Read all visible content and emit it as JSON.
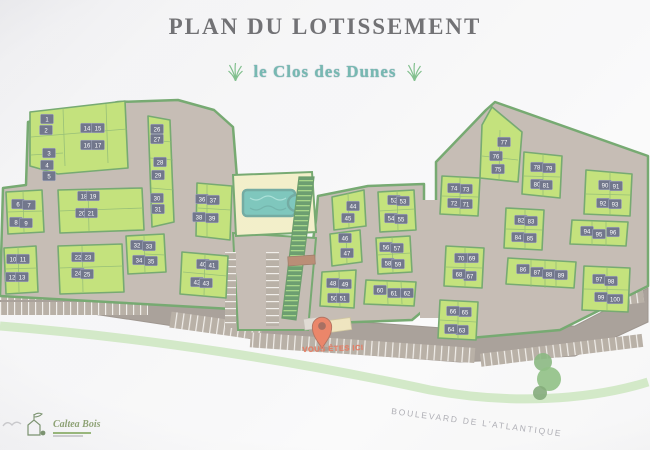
{
  "title": "PLAN DU LOTISSEMENT",
  "subtitle": "le Clos des Dunes",
  "you_are_here_label": "VOUS ÊTES ICI",
  "street_label": "BOULEVARD DE L'ATLANTIQUE",
  "logo": {
    "name": "Caltea Bois"
  },
  "colors": {
    "parcel_green": "#a5d337",
    "hedge_green": "#2e7d27",
    "road_taupe": "#a79a8e",
    "boulevard": "#7d7065",
    "lot_chip": "#262e4e",
    "pool_teal": "#3aa99a",
    "pool_parcel_tan": "#ece7ad",
    "pin_red": "#e0451a",
    "subtitle_teal": "#2e9488"
  },
  "map": {
    "lot_count": 100,
    "lots": [
      [
        1,
        47,
        119
      ],
      [
        2,
        46,
        130
      ],
      [
        3,
        49,
        153
      ],
      [
        4,
        47,
        165
      ],
      [
        5,
        49,
        176
      ],
      [
        6,
        18,
        204
      ],
      [
        7,
        29,
        205
      ],
      [
        8,
        16,
        222
      ],
      [
        9,
        26,
        223
      ],
      [
        10,
        13,
        259
      ],
      [
        11,
        23,
        259
      ],
      [
        12,
        12,
        277
      ],
      [
        13,
        22,
        277
      ],
      [
        14,
        87,
        128
      ],
      [
        15,
        98,
        128
      ],
      [
        16,
        87,
        145
      ],
      [
        17,
        98,
        145
      ],
      [
        18,
        84,
        196
      ],
      [
        19,
        93,
        196
      ],
      [
        20,
        82,
        213
      ],
      [
        21,
        91,
        213
      ],
      [
        22,
        78,
        257
      ],
      [
        23,
        88,
        257
      ],
      [
        24,
        78,
        273
      ],
      [
        25,
        87,
        274
      ],
      [
        26,
        157,
        129
      ],
      [
        27,
        157,
        139
      ],
      [
        28,
        160,
        162
      ],
      [
        29,
        158,
        175
      ],
      [
        30,
        157,
        198
      ],
      [
        31,
        158,
        209
      ],
      [
        32,
        137,
        245
      ],
      [
        33,
        149,
        246
      ],
      [
        34,
        139,
        260
      ],
      [
        35,
        151,
        261
      ],
      [
        36,
        202,
        199
      ],
      [
        37,
        213,
        200
      ],
      [
        38,
        199,
        217
      ],
      [
        39,
        212,
        218
      ],
      [
        40,
        203,
        264
      ],
      [
        41,
        212,
        265
      ],
      [
        42,
        197,
        282
      ],
      [
        43,
        206,
        283
      ],
      [
        44,
        353,
        206
      ],
      [
        45,
        348,
        218
      ],
      [
        46,
        345,
        238
      ],
      [
        47,
        347,
        253
      ],
      [
        48,
        333,
        283
      ],
      [
        49,
        345,
        284
      ],
      [
        50,
        334,
        298
      ],
      [
        51,
        343,
        298
      ],
      [
        52,
        394,
        200
      ],
      [
        53,
        403,
        201
      ],
      [
        54,
        391,
        218
      ],
      [
        55,
        401,
        219
      ],
      [
        56,
        386,
        247
      ],
      [
        57,
        397,
        248
      ],
      [
        58,
        388,
        263
      ],
      [
        59,
        398,
        264
      ],
      [
        60,
        380,
        290
      ],
      [
        61,
        394,
        293
      ],
      [
        62,
        407,
        293
      ],
      [
        63,
        462,
        330
      ],
      [
        64,
        451,
        329
      ],
      [
        65,
        465,
        312
      ],
      [
        66,
        453,
        311
      ],
      [
        67,
        470,
        276
      ],
      [
        68,
        459,
        274
      ],
      [
        69,
        472,
        258
      ],
      [
        70,
        461,
        258
      ],
      [
        71,
        466,
        204
      ],
      [
        72,
        454,
        203
      ],
      [
        73,
        466,
        189
      ],
      [
        74,
        454,
        188
      ],
      [
        75,
        498,
        169
      ],
      [
        76,
        496,
        156
      ],
      [
        77,
        504,
        142
      ],
      [
        78,
        537,
        167
      ],
      [
        79,
        549,
        168
      ],
      [
        80,
        537,
        184
      ],
      [
        81,
        546,
        185
      ],
      [
        82,
        521,
        220
      ],
      [
        83,
        531,
        221
      ],
      [
        84,
        518,
        237
      ],
      [
        85,
        530,
        238
      ],
      [
        86,
        523,
        269
      ],
      [
        87,
        537,
        272
      ],
      [
        88,
        549,
        274
      ],
      [
        89,
        561,
        275
      ],
      [
        90,
        605,
        185
      ],
      [
        91,
        616,
        186
      ],
      [
        92,
        603,
        203
      ],
      [
        93,
        615,
        204
      ],
      [
        94,
        587,
        231
      ],
      [
        95,
        599,
        234
      ],
      [
        96,
        613,
        232
      ],
      [
        97,
        599,
        279
      ],
      [
        98,
        611,
        281
      ],
      [
        99,
        601,
        297
      ],
      [
        100,
        615,
        299
      ]
    ]
  }
}
